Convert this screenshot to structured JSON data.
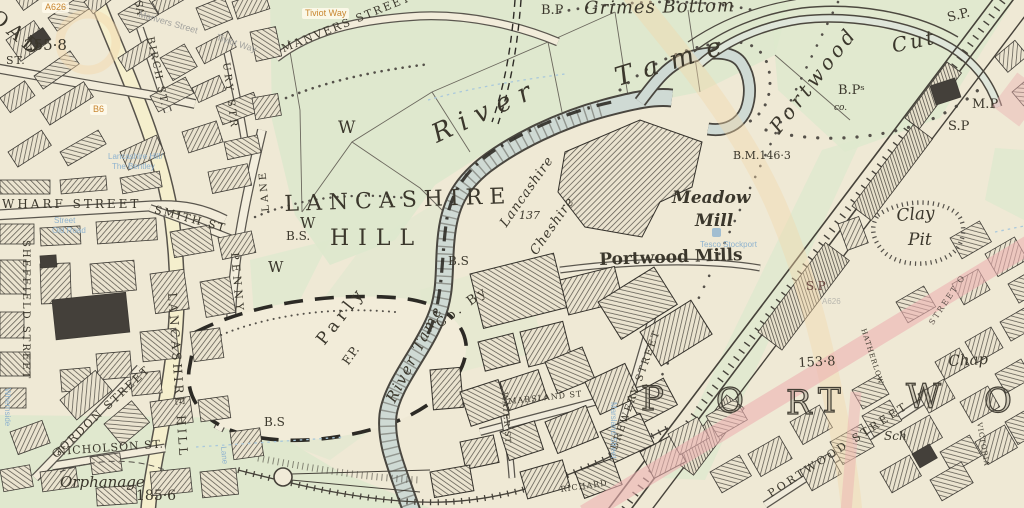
{
  "map_title": "Historic town map, Portwood / Lancashire Hill (River Tame)",
  "colors": {
    "paper": "#f1ebd8",
    "meadow_green": "#dde8cd",
    "ink": "#3b372c",
    "river": "#cfdad4",
    "modern_pink": "#ecb2b2",
    "modern_orange": "#f3d6aa",
    "overlay_gray": "#a2a29e",
    "overlay_blue": "#8fb3cf",
    "chip_orange": "#c9862f"
  },
  "labels": {
    "oad": "OAD",
    "st_top": "ST.",
    "n255": "255·8",
    "wharf_street": "WHARF  STREET",
    "smith_st": "SMITH  ST",
    "sheffield_street": "SHEFFIELD STREET",
    "lancashire_hill_road": "LANCASHIRE  HILL",
    "penny": "PENNY",
    "lane": "LANE",
    "sa": "SA",
    "birch_st": "BIRCH ST.",
    "ury_str": "URY  STR",
    "manvers_street": "MANVERS  STREET",
    "gordon_street": "GORDON  STREET",
    "nicholson_st": "NICHOLSON  ST.",
    "orphanage": "Orphanage",
    "n185": "185·6",
    "bp_top": "B.P",
    "grimes_bottom": "Grimes  Bottom",
    "river_big": "River",
    "tame_big": "Tame",
    "river_tame2": "River  Tame",
    "portwood_cut_1": "Portwood",
    "portwood_cut_2": "Cut",
    "sp_topright": "S.P.",
    "bps": "B.Pˢ",
    "co_small": "co.",
    "mp": "M.P",
    "sp_right": "S.P",
    "bm146": "B.M.146·3",
    "w1": "W",
    "w2": "W",
    "w3": "W",
    "bs1": "B.S.",
    "bs2": "B.S",
    "bs3": "B.S",
    "lancashire_big": "LANCASHIRE",
    "hill_big": "HILL",
    "parly": "Parly",
    "fp": "F.P.",
    "co_by": "Co.  By",
    "lancashire_county": "Lancashire",
    "cheshire_county": "Cheshire",
    "n137": "137",
    "meadow": "Meadow",
    "mill": "Mill",
    "portwood_mills": "Portwood Mills",
    "brewery_street": "BREWERY  STREET",
    "marsland_st": "MARSLAND  ST",
    "water_st": "WATER ST",
    "richard": "RICHARD",
    "clay": "Clay",
    "pit": "Pit",
    "sp_mid": "S.P",
    "n153": "153·8",
    "hatherlow": "HATHERLOW",
    "victoria": "VICTORIA",
    "street_pink": "STREET O",
    "chap": "Chap",
    "sch": "Sch",
    "portwood_street": "PORTWOOD  STREET"
  },
  "big_letters": {
    "portwood": [
      "P",
      "O",
      "R",
      "T",
      "W",
      "O"
    ]
  },
  "overlay_chips": {
    "a626": "A626",
    "b6": "B6",
    "tiviot_way": "Tiviot Way"
  },
  "overlay_gray": {
    "manvers": "Manvers Street",
    "tiviot": "Tiviot Way",
    "a626_faint": "A626"
  },
  "overlay_blue": {
    "bentley_l1": "Lancashire Hill/",
    "bentley_l2": "The Bentley",
    "oldroad_l1": "Street",
    "oldroad_l2": "Old Road",
    "tesco": "Tesco Stockport",
    "whernside": "Whernside",
    "marsland": "Marsland Street",
    "lane": "Lane"
  }
}
